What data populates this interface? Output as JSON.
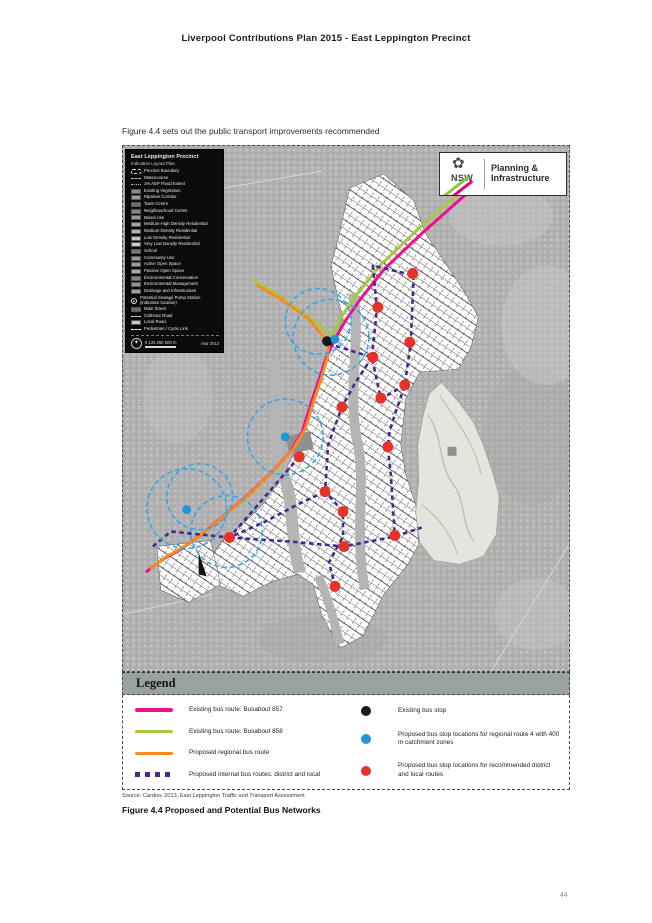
{
  "page": {
    "header": "Liverpool Contributions Plan 2015 - East Leppington Precinct",
    "intro": "Figure 4.4 sets out the public transport improvements recommended",
    "source": "Source: Cardno, 2013, East Leppington Traffic and Transport Assessment",
    "caption": "Figure 4.4 Proposed and Potential Bus Networks",
    "page_number": "44"
  },
  "logo": {
    "org": "NSW",
    "line1": "Planning &",
    "line2": "Infrastructure"
  },
  "ilp_legend": {
    "title": "East Leppington Precinct",
    "subtitle": "Indicative Layout Plan",
    "scale_label": "0  125  250  500 m",
    "date": "Mar 2013",
    "items": [
      {
        "type": "outline-dash",
        "color": "#dddddd",
        "label": "Precinct Boundary"
      },
      {
        "type": "dash-line",
        "color": "#bbbbbb",
        "label": "Watercourse"
      },
      {
        "type": "zigzag",
        "color": "#bbbbbb",
        "label": "1% AEP Flood Extent"
      },
      {
        "type": "fill",
        "color": "#8a8a8a",
        "label": "Existing Vegetation"
      },
      {
        "type": "fill",
        "color": "#9e9e9e",
        "label": "Riparian Corridor"
      },
      {
        "type": "fill",
        "color": "#6f6f6f",
        "label": "Town Centre"
      },
      {
        "type": "fill",
        "color": "#848484",
        "label": "Neighbourhood Centre"
      },
      {
        "type": "fill",
        "color": "#989898",
        "label": "Mixed Use"
      },
      {
        "type": "fill",
        "color": "#a8a8a8",
        "label": "Medium-High Density Residential"
      },
      {
        "type": "fill",
        "color": "#b5b5b5",
        "label": "Medium Density Residential"
      },
      {
        "type": "fill",
        "color": "#c2c2c2",
        "label": "Low Density Residential"
      },
      {
        "type": "fill",
        "color": "#cfcfcf",
        "label": "Very Low Density Residential"
      },
      {
        "type": "fill",
        "color": "#777777",
        "label": "School"
      },
      {
        "type": "fill",
        "color": "#8f8f8f",
        "label": "Community Use"
      },
      {
        "type": "fill",
        "color": "#9b9b9b",
        "label": "Active Open Space"
      },
      {
        "type": "fill",
        "color": "#ababab",
        "label": "Passive Open Space"
      },
      {
        "type": "fill",
        "color": "#838383",
        "label": "Environmental Conservation"
      },
      {
        "type": "fill",
        "color": "#949494",
        "label": "Environmental Management"
      },
      {
        "type": "fill",
        "color": "#a0a0a0",
        "label": "Drainage and Infrastructure"
      },
      {
        "type": "circle-p",
        "color": "#ffffff",
        "label": "Potential Sewage Pump Station (indicative location)"
      },
      {
        "type": "fill",
        "color": "#6a6a6a",
        "label": "Main Street"
      },
      {
        "type": "dash-line",
        "color": "#d9d9d9",
        "label": "Collector Road"
      },
      {
        "type": "fill",
        "color": "#c8c8c8",
        "label": "Local Road"
      },
      {
        "type": "dash-line",
        "color": "#efefef",
        "label": "Pedestrian / Cycle Link"
      }
    ]
  },
  "legend": {
    "title": "Legend",
    "left": [
      {
        "type": "line",
        "color": "#ef0e8e",
        "label": "Existing bus route: Busabout 857"
      },
      {
        "type": "line",
        "color": "#a5c93c",
        "label": "Existing bus route: Busabout 858"
      },
      {
        "type": "line",
        "color": "#f68b1f",
        "label": "Proposed regional bus route"
      },
      {
        "type": "squares",
        "color": "#44278f",
        "label": "Proposed internal bus routes: district and local"
      }
    ],
    "right": [
      {
        "type": "dot",
        "color": "#1a1a1a",
        "label": "Existing bus stop"
      },
      {
        "type": "dot",
        "color": "#2196d6",
        "label": "Proposed bus stop locations for regional route 4 with 400 m catchment zones"
      },
      {
        "type": "dot",
        "color": "#e6332a",
        "label": "Proposed bus stop locations for recommended district and local routes"
      }
    ]
  },
  "map_geometry": {
    "routes": [
      {
        "name": "existing-busabout-857",
        "color": "#ef0e8e",
        "width": 3,
        "dash": null,
        "points": [
          [
            353,
            41
          ],
          [
            301,
            87
          ],
          [
            263,
            123
          ],
          [
            239,
            153
          ],
          [
            223,
            176
          ],
          [
            213,
            194
          ],
          [
            204,
            213
          ],
          [
            196,
            237
          ],
          [
            188,
            261
          ],
          [
            180,
            287
          ],
          [
            168,
            307
          ],
          [
            150,
            327
          ],
          [
            127,
            349
          ],
          [
            106,
            367
          ],
          [
            80,
            389
          ],
          [
            58,
            405
          ],
          [
            40,
            415
          ],
          [
            24,
            427
          ]
        ]
      },
      {
        "name": "existing-busabout-858",
        "color": "#a5c93c",
        "width": 3,
        "dash": null,
        "points": [
          [
            349,
            37
          ],
          [
            297,
            83
          ],
          [
            259,
            119
          ],
          [
            235,
            149
          ],
          [
            219,
            172
          ],
          [
            211,
            191
          ],
          [
            183,
            169
          ],
          [
            155,
            149
          ],
          [
            131,
            135
          ]
        ]
      },
      {
        "name": "proposed-regional",
        "color": "#f68b1f",
        "width": 3,
        "dash": null,
        "points": [
          [
            135,
            140
          ],
          [
            159,
            154
          ],
          [
            187,
            174
          ],
          [
            206,
            197
          ],
          [
            206,
            210
          ],
          [
            199,
            234
          ],
          [
            191,
            258
          ],
          [
            183,
            284
          ],
          [
            171,
            304
          ],
          [
            153,
            324
          ],
          [
            131,
            346
          ],
          [
            110,
            364
          ],
          [
            84,
            386
          ],
          [
            62,
            402
          ],
          [
            44,
            412
          ],
          [
            28,
            424
          ]
        ]
      },
      {
        "name": "internal-district-1",
        "color": "#44278f",
        "width": 2.6,
        "dash": "4.5 3.5",
        "points": [
          [
            250,
            212
          ],
          [
            255,
            164
          ],
          [
            251,
            120
          ],
          [
            292,
            130
          ]
        ]
      },
      {
        "name": "internal-district-2",
        "color": "#44278f",
        "width": 2.6,
        "dash": "4.5 3.5",
        "points": [
          [
            292,
            130
          ],
          [
            289,
            198
          ],
          [
            283,
            240
          ],
          [
            268,
            285
          ],
          [
            266,
            302
          ],
          [
            269,
            330
          ],
          [
            273,
            390
          ]
        ]
      },
      {
        "name": "internal-district-3",
        "color": "#44278f",
        "width": 2.6,
        "dash": "4.5 3.5",
        "points": [
          [
            283,
            240
          ],
          [
            259,
            254
          ],
          [
            250,
            212
          ],
          [
            208,
            199
          ]
        ]
      },
      {
        "name": "internal-district-4",
        "color": "#44278f",
        "width": 2.6,
        "dash": "4.5 3.5",
        "points": [
          [
            250,
            212
          ],
          [
            232,
            240
          ],
          [
            220,
            262
          ],
          [
            206,
            300
          ],
          [
            203,
            347
          ],
          [
            221,
            367
          ],
          [
            221,
            392
          ],
          [
            207,
            418
          ],
          [
            213,
            442
          ]
        ]
      },
      {
        "name": "internal-local-1",
        "color": "#44278f",
        "width": 2.6,
        "dash": "4.5 3.5",
        "points": [
          [
            107,
            393
          ],
          [
            167,
            397
          ],
          [
            222,
            402
          ],
          [
            273,
            392
          ],
          [
            300,
            383
          ]
        ]
      },
      {
        "name": "internal-local-2",
        "color": "#44278f",
        "width": 2.6,
        "dash": "4.5 3.5",
        "points": [
          [
            30,
            402
          ],
          [
            48,
            387
          ],
          [
            107,
            393
          ],
          [
            143,
            377
          ],
          [
            175,
            360
          ],
          [
            203,
            347
          ]
        ]
      },
      {
        "name": "internal-local-3",
        "color": "#44278f",
        "width": 2.6,
        "dash": "4.5 3.5",
        "points": [
          [
            177,
            312
          ],
          [
            140,
            355
          ],
          [
            107,
            393
          ]
        ]
      }
    ],
    "catchments": {
      "color": "#35a7e5",
      "width": 1.6,
      "dash": "5 3",
      "circles": [
        [
          209,
          192,
          38
        ],
        [
          196,
          176,
          33
        ],
        [
          163,
          292,
          38
        ],
        [
          64,
          364,
          40
        ],
        [
          77,
          352,
          33
        ],
        [
          104,
          387,
          36
        ]
      ]
    },
    "stops": [
      {
        "name": "existing-stop",
        "color": "#151515",
        "r": 5,
        "points": [
          [
            205,
            196
          ]
        ]
      },
      {
        "name": "regional-stop",
        "color": "#2196d6",
        "r": 4.5,
        "points": [
          [
            213,
            194
          ],
          [
            163,
            292
          ],
          [
            64,
            365
          ]
        ]
      },
      {
        "name": "district-local-stop",
        "color": "#e6332a",
        "r": 5.5,
        "points": [
          [
            291,
            128
          ],
          [
            256,
            162
          ],
          [
            288,
            197
          ],
          [
            251,
            212
          ],
          [
            283,
            240
          ],
          [
            220,
            262
          ],
          [
            259,
            253
          ],
          [
            266,
            302
          ],
          [
            177,
            312
          ],
          [
            203,
            347
          ],
          [
            221,
            367
          ],
          [
            273,
            391
          ],
          [
            222,
            402
          ],
          [
            107,
            393
          ],
          [
            213,
            442
          ]
        ]
      }
    ]
  }
}
